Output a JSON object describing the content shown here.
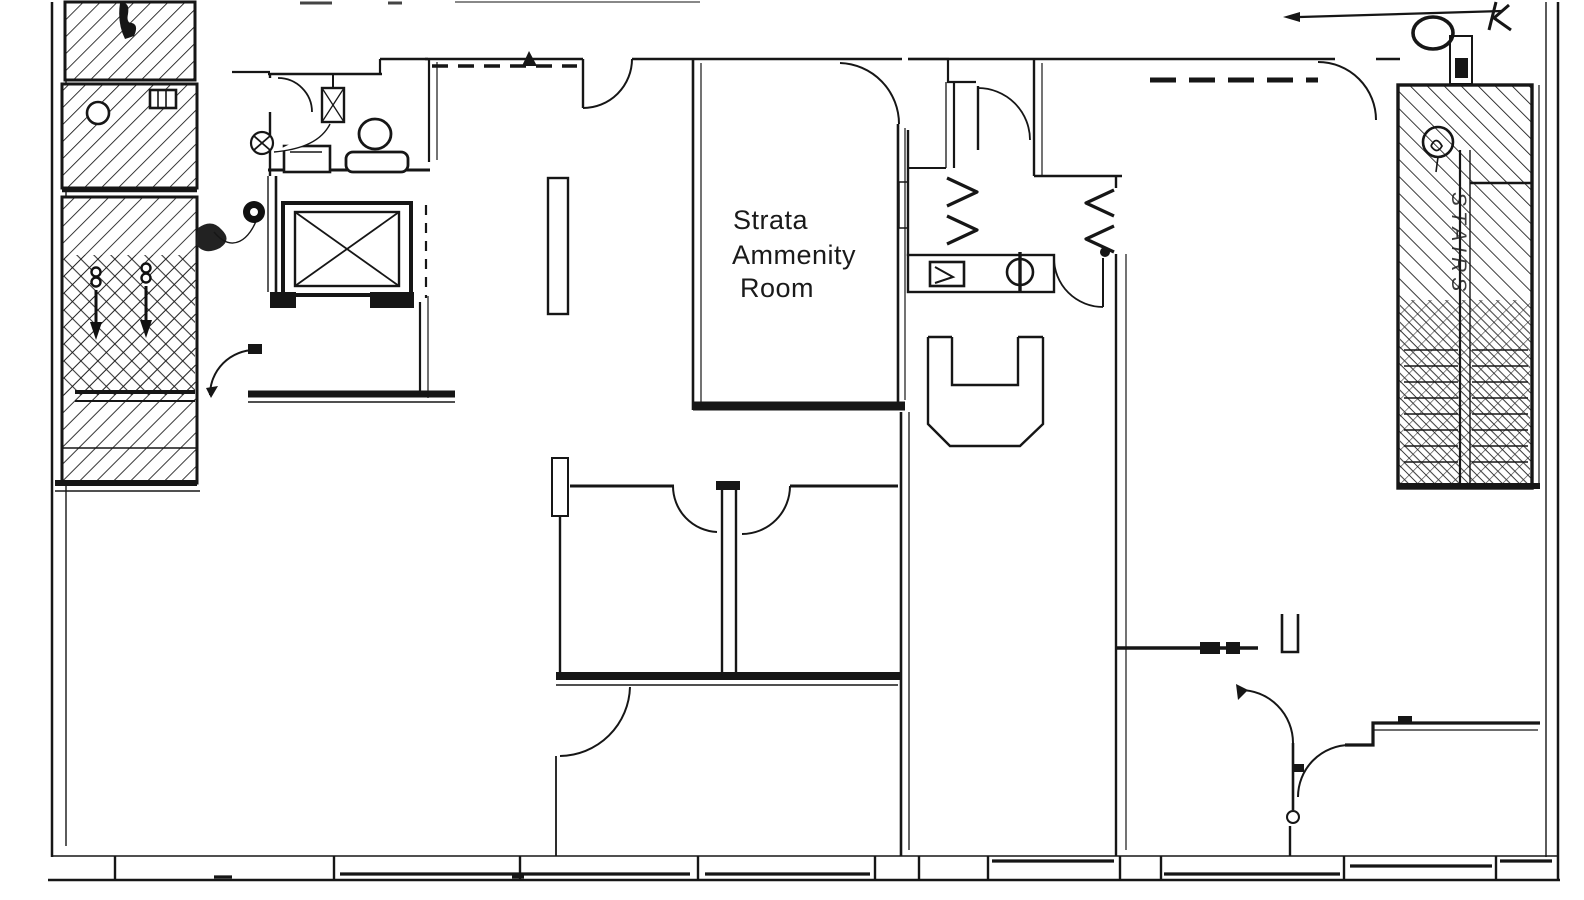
{
  "drawing": {
    "background": "#ffffff",
    "ink": "#1a1a1a",
    "hatch_color": "#161616",
    "type": "architectural floor plan, black line work on white"
  },
  "labels": {
    "amenity_room": {
      "line1": "Strata",
      "line2": "Ammenity",
      "line3": "Room"
    },
    "stairwell_right": "STAIRS"
  },
  "icons": {
    "elevator": "crossed-box elevator shaft",
    "toilet": "circle bowl with tank",
    "sink": "small rectangle basin",
    "exhaust_fan": "circled X",
    "door_swing": "quarter-circle arc",
    "stair_hatch": "diagonal hatching",
    "window_band": "segmented double line with mullions"
  }
}
